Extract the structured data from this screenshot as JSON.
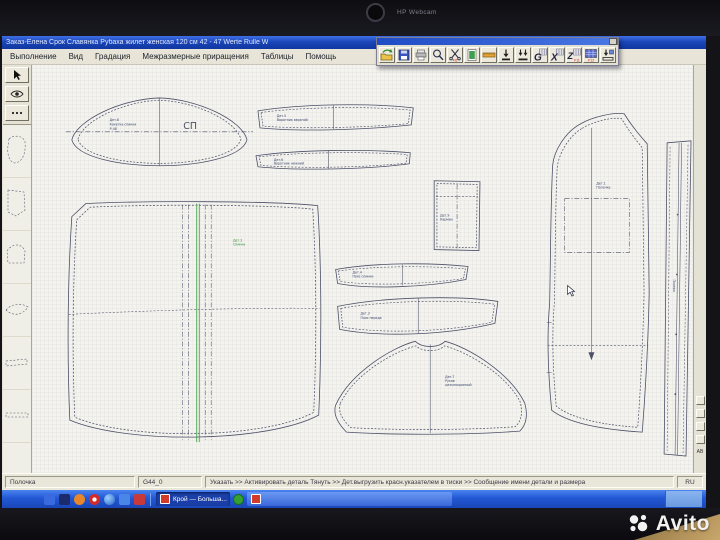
{
  "device": {
    "webcam_label": "HP Webcam",
    "watermark": "Avito"
  },
  "window": {
    "title": "Заказ-Елена Срок Славянка Рубаха жилет женская 120 см 42 - 47   Werte Rulle W"
  },
  "menu": {
    "items": [
      {
        "label": "Выполнение"
      },
      {
        "label": "Вид"
      },
      {
        "label": "Градация"
      },
      {
        "label": "Межразмерные приращения"
      },
      {
        "label": "Таблицы"
      },
      {
        "label": "Помощь"
      }
    ]
  },
  "toolbar": {
    "buttons": [
      {
        "name": "open"
      },
      {
        "name": "save"
      },
      {
        "name": "print"
      },
      {
        "name": "zoom"
      },
      {
        "name": "cut",
        "badge": "F6"
      },
      {
        "name": "preview"
      },
      {
        "name": "ruler"
      },
      {
        "name": "load-detail"
      },
      {
        "name": "load-all"
      },
      {
        "name": "table-g",
        "glyph": "G"
      },
      {
        "name": "table-x",
        "glyph": "X"
      },
      {
        "name": "table-z",
        "glyph": "Z",
        "badge": "F11"
      },
      {
        "name": "table-f12",
        "badge": "F12"
      },
      {
        "name": "unload"
      }
    ]
  },
  "pieces": {
    "yoke": {
      "label": "СП",
      "lines": [
        "Дет.8",
        "Кокетка спинки",
        "Р-48"
      ]
    },
    "collar_top": {
      "lines": [
        "Дет.5",
        "Воротник верхний"
      ]
    },
    "collar_bottom": {
      "lines": [
        "Дет.6",
        "Воротник нижний"
      ]
    },
    "pocket": {
      "lines": [
        "Дет.9",
        "Карман"
      ]
    },
    "back": {
      "lines": [
        "Дет.2",
        "Спинка"
      ]
    },
    "band_top": {
      "lines": [
        "Дет.4",
        "Пояс спинки"
      ]
    },
    "band_bottom": {
      "lines": [
        "Дет.3",
        "Пояс переда"
      ]
    },
    "sleeve": {
      "lines": [
        "Дет.7",
        "Рукав",
        "цельнокроеный"
      ]
    },
    "front": {
      "lines": [
        "Дет.1",
        "Полочка"
      ]
    },
    "placket": {
      "label": "Планка"
    }
  },
  "right_panel": {
    "label": "AB"
  },
  "status": {
    "detail": "Полочка",
    "cell": "G44_0",
    "hint": "Указать >> Активировать деталь Тянуть >> Дет.выгрузить красн.указателем в тиски >> Сообщение имени детали и размера",
    "lang": "RU"
  },
  "taskbar": {
    "task1_label": "Крой — Больша...",
    "task2_label": ""
  }
}
